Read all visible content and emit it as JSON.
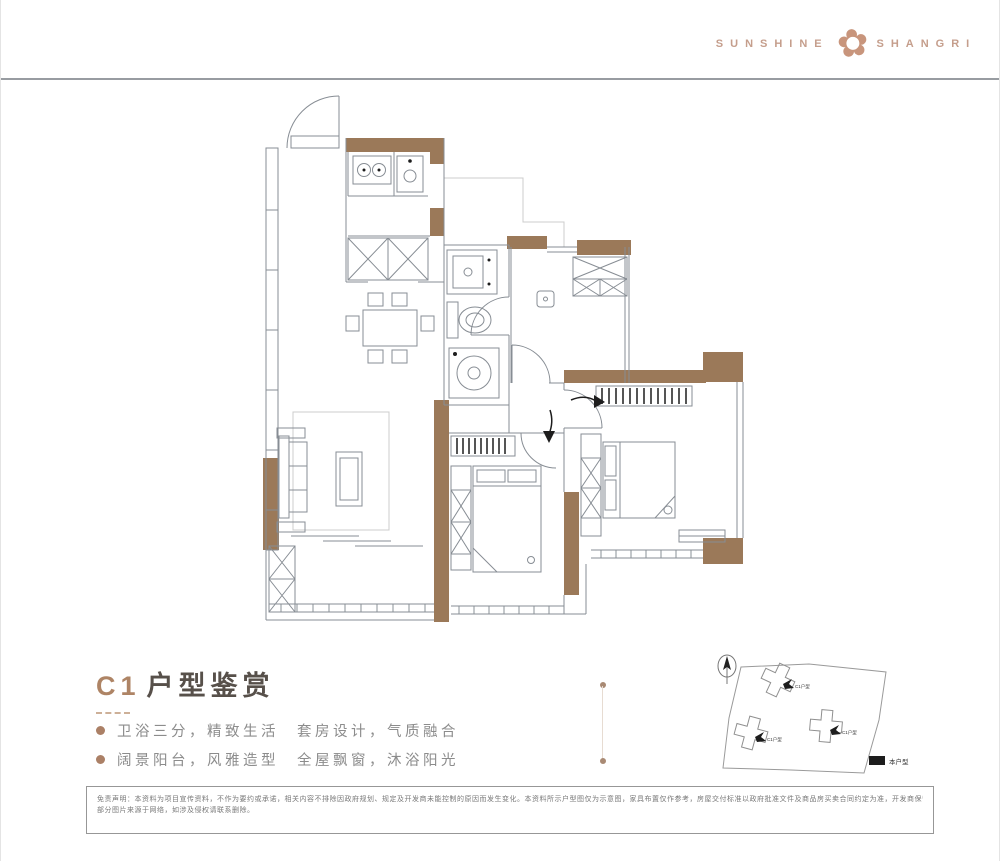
{
  "header": {
    "logo_left": "SUNSHINE",
    "logo_right": "SHANGRI",
    "flower_icon": "✿"
  },
  "title": {
    "code": "C1",
    "name": "户型鉴赏"
  },
  "features": [
    {
      "text": "卫浴三分，精致生活　套房设计，气质融合"
    },
    {
      "text": "阔景阳台，风雅造型　全屋飘窗，沐浴阳光"
    }
  ],
  "sitemap": {
    "legend_label": "本户型",
    "buildings": [
      {
        "label": "C1户型"
      },
      {
        "label": "C1户型"
      },
      {
        "label": "C1户型"
      }
    ]
  },
  "disclaimer": {
    "line1": "免责声明：本资料为项目宣传资料，不作为要约或承诺，相关内容不排除因政府规划、规定及开发商未能控制的原因而发生变化。本资料所示户型图仅为示意图，家具布置仅作参考，房屋交付标准以政府批准文件及商品房买卖合同约定为准，开发商保留修改权利。",
    "line2": "部分图片来源于网络，如涉及侵权请联系删除。"
  },
  "colors": {
    "wall": "#9b7959",
    "plan_line": "#878d94",
    "brand": "#c59e8c",
    "title_code": "#ae8465",
    "title_text": "#57504a",
    "feature_text": "#8c8c8c"
  }
}
